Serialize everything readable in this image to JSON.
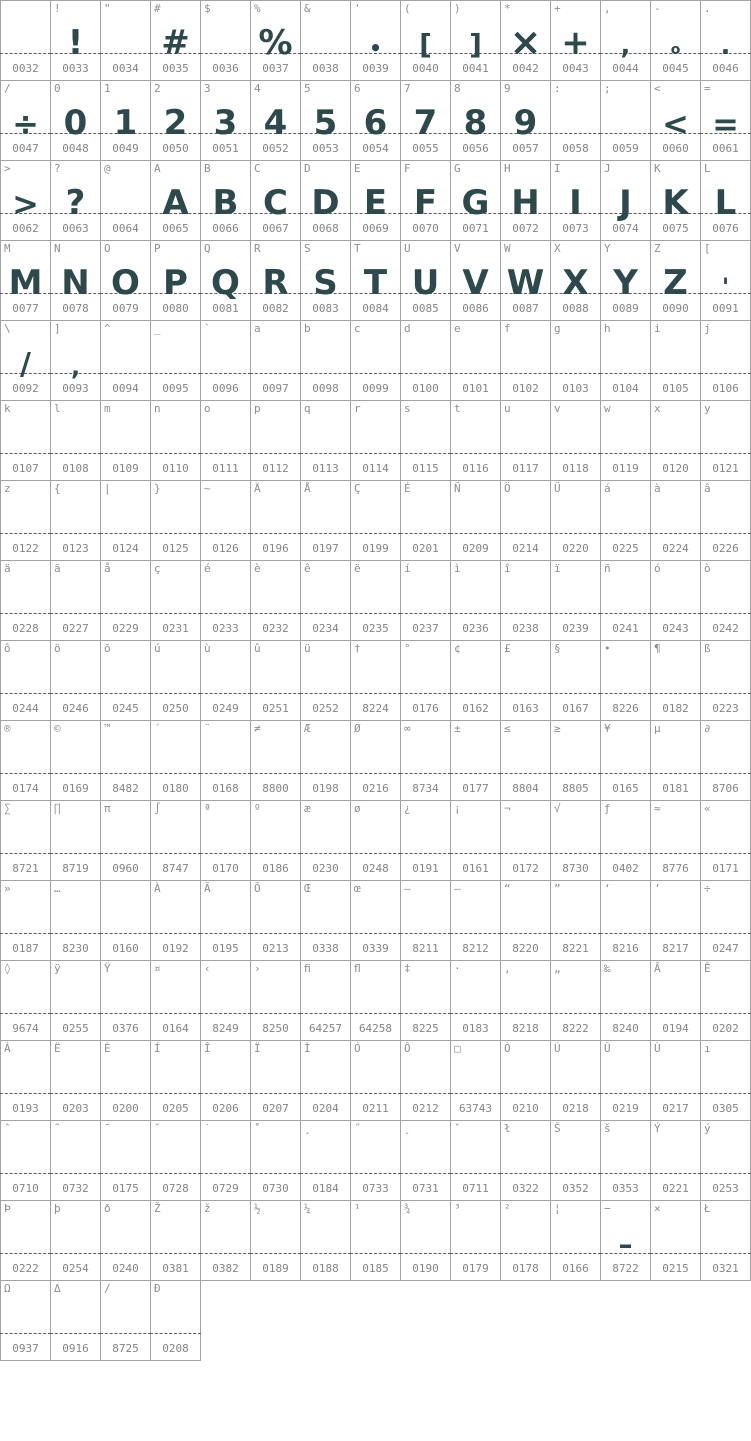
{
  "app": {
    "description": "Font character map grid preview",
    "columns": 15,
    "cell_width_px": 50,
    "cell_height_px": 80,
    "baseline_y_px": 52
  },
  "colors": {
    "glyph": "#2e494b",
    "label_text": "#8f8f8f",
    "code_text": "#858585",
    "cell_border": "#a3a3a3",
    "baseline_dash": "#5c5c5c",
    "background": "#ffffff"
  },
  "cell_fields": [
    "label",
    "code",
    "glyph",
    "glyph_size_px"
  ],
  "rows": [
    [
      [
        "",
        "0032",
        ""
      ],
      [
        "!",
        "0033",
        "!"
      ],
      [
        "\"",
        "0034",
        ""
      ],
      [
        "#",
        "0035",
        "#"
      ],
      [
        "$",
        "0036",
        ""
      ],
      [
        "%",
        "0037",
        "%"
      ],
      [
        "&",
        "0038",
        ""
      ],
      [
        "'",
        "0039",
        "•",
        20
      ],
      [
        "(",
        "0040",
        "[",
        28
      ],
      [
        ")",
        "0041",
        "]",
        28
      ],
      [
        "*",
        "0042",
        "×",
        38
      ],
      [
        "+",
        "0043",
        "+",
        34
      ],
      [
        ",",
        "0044",
        ",",
        26
      ],
      [
        "-",
        "0045",
        "o",
        14
      ],
      [
        ".",
        "0046",
        ".",
        26
      ]
    ],
    [
      [
        "/",
        "0047",
        "÷",
        32
      ],
      [
        "0",
        "0048",
        "0"
      ],
      [
        "1",
        "0049",
        "1"
      ],
      [
        "2",
        "0050",
        "2"
      ],
      [
        "3",
        "0051",
        "3"
      ],
      [
        "4",
        "0052",
        "4"
      ],
      [
        "5",
        "0053",
        "5"
      ],
      [
        "6",
        "0054",
        "6"
      ],
      [
        "7",
        "0055",
        "7"
      ],
      [
        "8",
        "0056",
        "8"
      ],
      [
        "9",
        "0057",
        "9"
      ],
      [
        ":",
        "0058",
        ""
      ],
      [
        ";",
        "0059",
        ""
      ],
      [
        "<",
        "0060",
        "<",
        32
      ],
      [
        "=",
        "0061",
        "=",
        32
      ]
    ],
    [
      [
        ">",
        "0062",
        ">",
        32
      ],
      [
        "?",
        "0063",
        "?"
      ],
      [
        "@",
        "0064",
        ""
      ],
      [
        "A",
        "0065",
        "A"
      ],
      [
        "B",
        "0066",
        "B"
      ],
      [
        "C",
        "0067",
        "C"
      ],
      [
        "D",
        "0068",
        "D"
      ],
      [
        "E",
        "0069",
        "E"
      ],
      [
        "F",
        "0070",
        "F"
      ],
      [
        "G",
        "0071",
        "G"
      ],
      [
        "H",
        "0072",
        "H"
      ],
      [
        "I",
        "0073",
        "I"
      ],
      [
        "J",
        "0074",
        "J"
      ],
      [
        "K",
        "0075",
        "K"
      ],
      [
        "L",
        "0076",
        "L"
      ]
    ],
    [
      [
        "M",
        "0077",
        "M"
      ],
      [
        "N",
        "0078",
        "N"
      ],
      [
        "O",
        "0079",
        "O"
      ],
      [
        "P",
        "0080",
        "P"
      ],
      [
        "Q",
        "0081",
        "Q"
      ],
      [
        "R",
        "0082",
        "R"
      ],
      [
        "S",
        "0083",
        "S"
      ],
      [
        "T",
        "0084",
        "T"
      ],
      [
        "U",
        "0085",
        "U"
      ],
      [
        "V",
        "0086",
        "V"
      ],
      [
        "W",
        "0087",
        "W"
      ],
      [
        "X",
        "0088",
        "X"
      ],
      [
        "Y",
        "0089",
        "Y"
      ],
      [
        "Z",
        "0090",
        "Z"
      ],
      [
        "[",
        "0091",
        "'",
        24
      ]
    ],
    [
      [
        "\\",
        "0092",
        "/",
        30
      ],
      [
        "]",
        "0093",
        ",",
        24
      ],
      [
        "^",
        "0094",
        ""
      ],
      [
        "_",
        "0095",
        ""
      ],
      [
        "`",
        "0096",
        ""
      ],
      [
        "a",
        "0097",
        ""
      ],
      [
        "b",
        "0098",
        ""
      ],
      [
        "c",
        "0099",
        ""
      ],
      [
        "d",
        "0100",
        ""
      ],
      [
        "e",
        "0101",
        ""
      ],
      [
        "f",
        "0102",
        ""
      ],
      [
        "g",
        "0103",
        ""
      ],
      [
        "h",
        "0104",
        ""
      ],
      [
        "i",
        "0105",
        ""
      ],
      [
        "j",
        "0106",
        ""
      ]
    ],
    [
      [
        "k",
        "0107",
        ""
      ],
      [
        "l",
        "0108",
        ""
      ],
      [
        "m",
        "0109",
        ""
      ],
      [
        "n",
        "0110",
        ""
      ],
      [
        "o",
        "0111",
        ""
      ],
      [
        "p",
        "0112",
        ""
      ],
      [
        "q",
        "0113",
        ""
      ],
      [
        "r",
        "0114",
        ""
      ],
      [
        "s",
        "0115",
        ""
      ],
      [
        "t",
        "0116",
        ""
      ],
      [
        "u",
        "0117",
        ""
      ],
      [
        "v",
        "0118",
        ""
      ],
      [
        "w",
        "0119",
        ""
      ],
      [
        "x",
        "0120",
        ""
      ],
      [
        "y",
        "0121",
        ""
      ]
    ],
    [
      [
        "z",
        "0122",
        ""
      ],
      [
        "{",
        "0123",
        ""
      ],
      [
        "|",
        "0124",
        ""
      ],
      [
        "}",
        "0125",
        ""
      ],
      [
        "~",
        "0126",
        ""
      ],
      [
        "Ä",
        "0196",
        ""
      ],
      [
        "Å",
        "0197",
        ""
      ],
      [
        "Ç",
        "0199",
        ""
      ],
      [
        "É",
        "0201",
        ""
      ],
      [
        "Ñ",
        "0209",
        ""
      ],
      [
        "Ö",
        "0214",
        ""
      ],
      [
        "Ü",
        "0220",
        ""
      ],
      [
        "á",
        "0225",
        ""
      ],
      [
        "à",
        "0224",
        ""
      ],
      [
        "â",
        "0226",
        ""
      ]
    ],
    [
      [
        "ä",
        "0228",
        ""
      ],
      [
        "ã",
        "0227",
        ""
      ],
      [
        "å",
        "0229",
        ""
      ],
      [
        "ç",
        "0231",
        ""
      ],
      [
        "é",
        "0233",
        ""
      ],
      [
        "è",
        "0232",
        ""
      ],
      [
        "ê",
        "0234",
        ""
      ],
      [
        "ë",
        "0235",
        ""
      ],
      [
        "í",
        "0237",
        ""
      ],
      [
        "ì",
        "0236",
        ""
      ],
      [
        "î",
        "0238",
        ""
      ],
      [
        "ï",
        "0239",
        ""
      ],
      [
        "ñ",
        "0241",
        ""
      ],
      [
        "ó",
        "0243",
        ""
      ],
      [
        "ò",
        "0242",
        ""
      ]
    ],
    [
      [
        "ô",
        "0244",
        ""
      ],
      [
        "ö",
        "0246",
        ""
      ],
      [
        "õ",
        "0245",
        ""
      ],
      [
        "ú",
        "0250",
        ""
      ],
      [
        "ù",
        "0249",
        ""
      ],
      [
        "û",
        "0251",
        ""
      ],
      [
        "ü",
        "0252",
        ""
      ],
      [
        "†",
        "8224",
        ""
      ],
      [
        "°",
        "0176",
        ""
      ],
      [
        "¢",
        "0162",
        ""
      ],
      [
        "£",
        "0163",
        ""
      ],
      [
        "§",
        "0167",
        ""
      ],
      [
        "•",
        "8226",
        ""
      ],
      [
        "¶",
        "0182",
        ""
      ],
      [
        "ß",
        "0223",
        ""
      ]
    ],
    [
      [
        "®",
        "0174",
        ""
      ],
      [
        "©",
        "0169",
        ""
      ],
      [
        "™",
        "8482",
        ""
      ],
      [
        "´",
        "0180",
        ""
      ],
      [
        "¨",
        "0168",
        ""
      ],
      [
        "≠",
        "8800",
        ""
      ],
      [
        "Æ",
        "0198",
        ""
      ],
      [
        "Ø",
        "0216",
        ""
      ],
      [
        "∞",
        "8734",
        ""
      ],
      [
        "±",
        "0177",
        ""
      ],
      [
        "≤",
        "8804",
        ""
      ],
      [
        "≥",
        "8805",
        ""
      ],
      [
        "¥",
        "0165",
        ""
      ],
      [
        "µ",
        "0181",
        ""
      ],
      [
        "∂",
        "8706",
        ""
      ]
    ],
    [
      [
        "∑",
        "8721",
        ""
      ],
      [
        "∏",
        "8719",
        ""
      ],
      [
        "π",
        "0960",
        ""
      ],
      [
        "∫",
        "8747",
        ""
      ],
      [
        "ª",
        "0170",
        ""
      ],
      [
        "º",
        "0186",
        ""
      ],
      [
        "æ",
        "0230",
        ""
      ],
      [
        "ø",
        "0248",
        ""
      ],
      [
        "¿",
        "0191",
        ""
      ],
      [
        "¡",
        "0161",
        ""
      ],
      [
        "¬",
        "0172",
        ""
      ],
      [
        "√",
        "8730",
        ""
      ],
      [
        "ƒ",
        "0402",
        ""
      ],
      [
        "≈",
        "8776",
        ""
      ],
      [
        "«",
        "0171",
        ""
      ]
    ],
    [
      [
        "»",
        "0187",
        ""
      ],
      [
        "…",
        "8230",
        ""
      ],
      [
        "",
        "0160",
        ""
      ],
      [
        "À",
        "0192",
        ""
      ],
      [
        "Ã",
        "0195",
        ""
      ],
      [
        "Õ",
        "0213",
        ""
      ],
      [
        "Œ",
        "0338",
        ""
      ],
      [
        "œ",
        "0339",
        ""
      ],
      [
        "–",
        "8211",
        ""
      ],
      [
        "—",
        "8212",
        ""
      ],
      [
        "“",
        "8220",
        ""
      ],
      [
        "”",
        "8221",
        ""
      ],
      [
        "‘",
        "8216",
        ""
      ],
      [
        "’",
        "8217",
        ""
      ],
      [
        "÷",
        "0247",
        ""
      ]
    ],
    [
      [
        "◊",
        "9674",
        ""
      ],
      [
        "ÿ",
        "0255",
        ""
      ],
      [
        "Ÿ",
        "0376",
        ""
      ],
      [
        "¤",
        "0164",
        ""
      ],
      [
        "‹",
        "8249",
        ""
      ],
      [
        "›",
        "8250",
        ""
      ],
      [
        "ﬁ",
        "64257",
        ""
      ],
      [
        "ﬂ",
        "64258",
        ""
      ],
      [
        "‡",
        "8225",
        ""
      ],
      [
        "·",
        "0183",
        ""
      ],
      [
        "‚",
        "8218",
        ""
      ],
      [
        "„",
        "8222",
        ""
      ],
      [
        "‰",
        "8240",
        ""
      ],
      [
        "Â",
        "0194",
        ""
      ],
      [
        "Ê",
        "0202",
        ""
      ]
    ],
    [
      [
        "Á",
        "0193",
        ""
      ],
      [
        "Ë",
        "0203",
        ""
      ],
      [
        "È",
        "0200",
        ""
      ],
      [
        "Í",
        "0205",
        ""
      ],
      [
        "Î",
        "0206",
        ""
      ],
      [
        "Ï",
        "0207",
        ""
      ],
      [
        "Ì",
        "0204",
        ""
      ],
      [
        "Ó",
        "0211",
        ""
      ],
      [
        "Ô",
        "0212",
        ""
      ],
      [
        "□",
        "63743",
        ""
      ],
      [
        "Ò",
        "0210",
        ""
      ],
      [
        "Ú",
        "0218",
        ""
      ],
      [
        "Û",
        "0219",
        ""
      ],
      [
        "Ù",
        "0217",
        ""
      ],
      [
        "ı",
        "0305",
        ""
      ]
    ],
    [
      [
        "ˆ",
        "0710",
        ""
      ],
      [
        "˜",
        "0732",
        ""
      ],
      [
        "¯",
        "0175",
        ""
      ],
      [
        "˘",
        "0728",
        ""
      ],
      [
        "˙",
        "0729",
        ""
      ],
      [
        "˚",
        "0730",
        ""
      ],
      [
        "¸",
        "0184",
        ""
      ],
      [
        "˝",
        "0733",
        ""
      ],
      [
        "˛",
        "0731",
        ""
      ],
      [
        "ˇ",
        "0711",
        ""
      ],
      [
        "ł",
        "0322",
        ""
      ],
      [
        "Š",
        "0352",
        ""
      ],
      [
        "š",
        "0353",
        ""
      ],
      [
        "Ý",
        "0221",
        ""
      ],
      [
        "ý",
        "0253",
        ""
      ]
    ],
    [
      [
        "Þ",
        "0222",
        ""
      ],
      [
        "þ",
        "0254",
        ""
      ],
      [
        "ð",
        "0240",
        ""
      ],
      [
        "Ž",
        "0381",
        ""
      ],
      [
        "ž",
        "0382",
        ""
      ],
      [
        "½",
        "0189",
        ""
      ],
      [
        "¼",
        "0188",
        ""
      ],
      [
        "¹",
        "0185",
        ""
      ],
      [
        "¾",
        "0190",
        ""
      ],
      [
        "³",
        "0179",
        ""
      ],
      [
        "²",
        "0178",
        ""
      ],
      [
        "¦",
        "0166",
        ""
      ],
      [
        "−",
        "8722",
        "–",
        28
      ],
      [
        "×",
        "0215",
        ""
      ],
      [
        "Ł",
        "0321",
        ""
      ]
    ],
    [
      [
        "Ω",
        "0937",
        ""
      ],
      [
        "Δ",
        "0916",
        ""
      ],
      [
        "∕",
        "8725",
        ""
      ],
      [
        "Ð",
        "0208",
        ""
      ]
    ]
  ]
}
